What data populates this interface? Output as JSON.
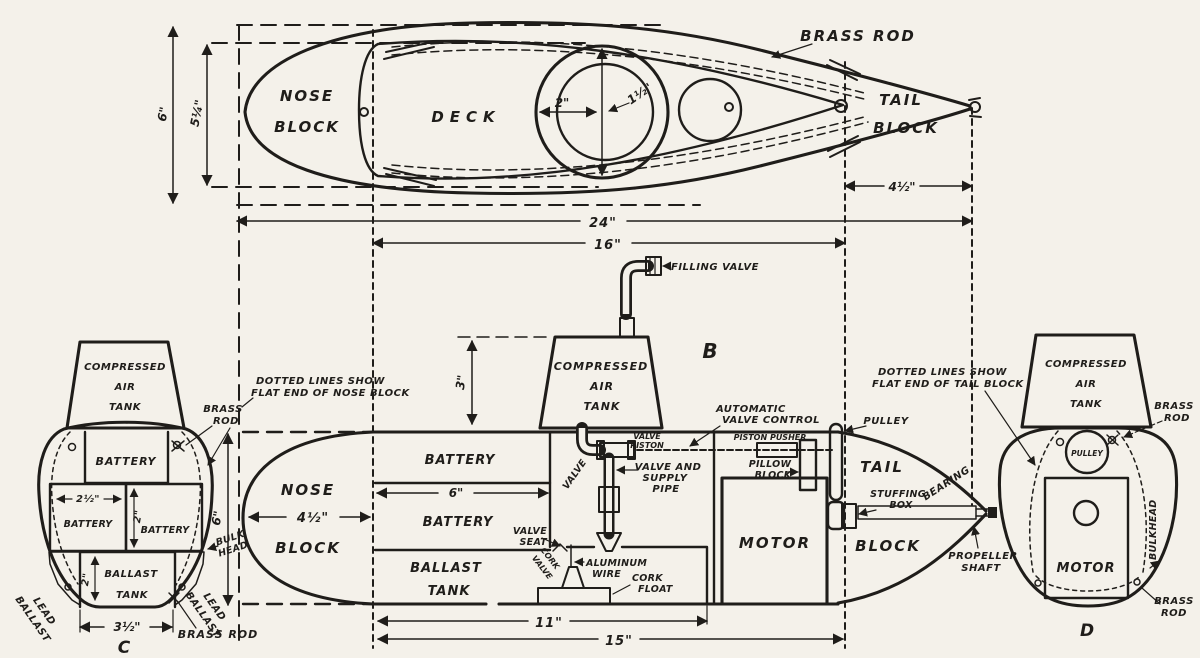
{
  "top_view": {
    "dim_height_outer": "6\"",
    "dim_height_inner": "5¼\"",
    "nose_block": [
      "NOSE",
      "BLOCK"
    ],
    "deck": "DECK",
    "dim_tower_outer": "2\"",
    "dim_tower_inner": "1½\"",
    "brass_rod": "BRASS ROD",
    "tail_block": [
      "TAIL",
      "BLOCK"
    ],
    "dim_tail": "4½\"",
    "dim_overall": "24\"",
    "dim_deck": "16\""
  },
  "side_view": {
    "view_label": "B",
    "filling_valve": "FILLING VALVE",
    "note_nose": [
      "DOTTED LINES SHOW",
      "FLAT END OF NOSE BLOCK"
    ],
    "note_tail": [
      "DOTTED LINES SHOW",
      "FLAT END OF TAIL BLOCK"
    ],
    "tank": [
      "COMPRESSED",
      "AIR",
      "TANK"
    ],
    "dim_tank_height": "3\"",
    "nose_block": [
      "NOSE",
      "BLOCK"
    ],
    "dim_nose": "4½\"",
    "battery_upper": "BATTERY",
    "dim_battery": "6\"",
    "battery_lower": "BATTERY",
    "ballast_tank": [
      "BALLAST",
      "TANK"
    ],
    "valve_seat": [
      "VALVE",
      "SEAT"
    ],
    "cork_valve": [
      "CORK",
      "VALVE"
    ],
    "aluminum_wire": [
      "ALUMINUM",
      "WIRE"
    ],
    "cork_float": [
      "CORK",
      "FLOAT"
    ],
    "valve": "VALVE",
    "valve_piston": [
      "VALVE",
      "PISTON"
    ],
    "valve_supply_pipe": [
      "VALVE AND",
      "SUPPLY",
      "PIPE"
    ],
    "automatic_valve_control": [
      "AUTOMATIC",
      "VALVE CONTROL"
    ],
    "piston_pusher": "PISTON PUSHER",
    "pillow_block": [
      "PILLOW",
      "BLOCK"
    ],
    "pulley": "PULLEY",
    "motor": "MOTOR",
    "tail_block": [
      "TAIL",
      "BLOCK"
    ],
    "stuffing_box": [
      "STUFFING",
      "BOX"
    ],
    "bearing": "BEARING",
    "propeller_shaft": [
      "PROPELLER",
      "SHAFT"
    ],
    "dim_ballast": "11\"",
    "dim_keel": "15\""
  },
  "section_c": {
    "label": "C",
    "tank": [
      "COMPRESSED",
      "AIR",
      "TANK"
    ],
    "brass_rod_top": [
      "BRASS",
      "ROD"
    ],
    "battery_top": "BATTERY",
    "battery_left": "BATTERY",
    "battery_right": "BATTERY",
    "dim_battery_width": "2½\"",
    "dim_battery_height": "2\"",
    "ballast_tank": [
      "BALLAST",
      "TANK"
    ],
    "dim_ballast_height": "2\"",
    "lead_ballast_left": [
      "LEAD",
      "BALLAST"
    ],
    "lead_ballast_right": [
      "LEAD",
      "BALLAST"
    ],
    "bulkhead": [
      "BULK",
      "HEAD"
    ],
    "dim_width": "3½\"",
    "dim_height": "6\"",
    "brass_rod_bottom": "BRASS ROD"
  },
  "section_d": {
    "label": "D",
    "tank": [
      "COMPRESSED",
      "AIR",
      "TANK"
    ],
    "brass_rod_top": [
      "BRASS",
      "ROD"
    ],
    "pulley": "PULLEY",
    "motor": "MOTOR",
    "bulkhead": "BULKHEAD",
    "brass_rod_bottom": [
      "BRASS",
      "ROD"
    ]
  }
}
